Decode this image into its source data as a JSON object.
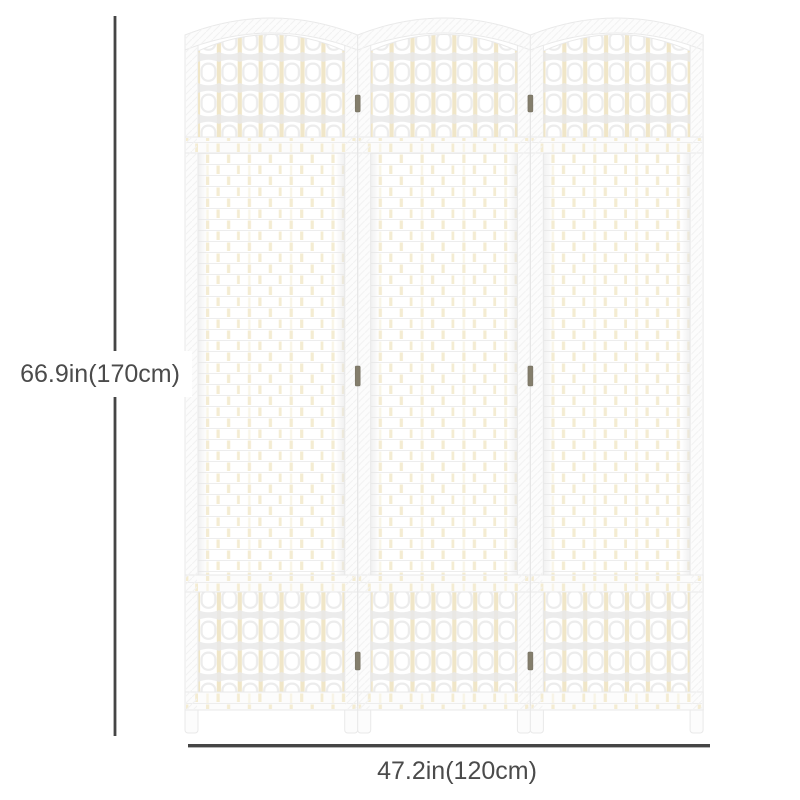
{
  "labels": {
    "height": "66.9in(170cm)",
    "width": "47.2in(120cm)"
  },
  "figure": {
    "type": "product-dimension-diagram",
    "subject": "3-panel white woven-wicker folding room divider",
    "panel_count": 3
  },
  "colors": {
    "dimension_line": "#454545",
    "dimension_text": "#4b4b4b",
    "frame_fill": "#fcfcfc",
    "frame_stroke": "#e9e9e9",
    "dowel_cream": "#f0e6c8",
    "weave_dash": "#f4ecd2",
    "lattice_shadow": "#e9e9e9",
    "lattice_hole_outline": "#ececec",
    "weave_line": "#ededed",
    "hinge": "#847e6c",
    "seam": "#e6e6e6"
  }
}
